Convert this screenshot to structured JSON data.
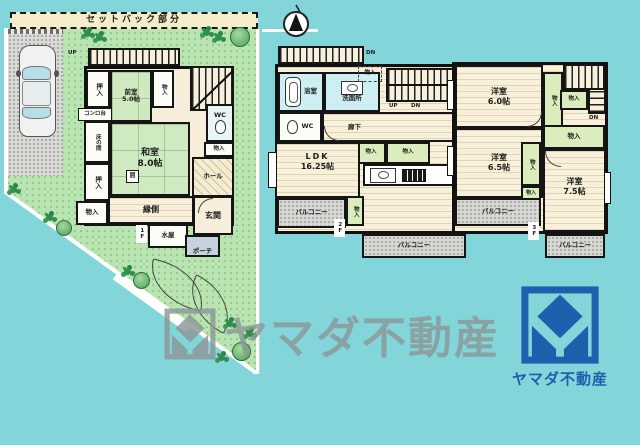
{
  "colors": {
    "background": "#82d5d8",
    "wall": "#151515",
    "lawn": "#b9e4b1",
    "tatami_green": "#cfe9c0",
    "wood_cream": "#f8f0da",
    "wet_room_cyan": "#cdeef2",
    "closet_green": "#dcedbd",
    "balcony_gray": "#d7d8d3",
    "setback_beige": "#f5edc9",
    "brand_blue": "#1d60ae",
    "watermark_gray": "#8c9898"
  },
  "icons": {
    "compass_north": "north-arrow",
    "bathtub": "tub-outline",
    "toilet": "toilet-oval",
    "kitchen_sink": "sink-rect",
    "kitchen_stove": "stove-grill",
    "yamada_mark": "square-diamond-house"
  },
  "site": {
    "setback_label": "セットバック部分"
  },
  "floor1": {
    "tag": "1F",
    "deck_up": "UP",
    "oshiire_a": "押入",
    "zenshitsu_name": "前室",
    "zenshitsu_size": "5.0帖",
    "monoiri_top": "物入",
    "konrodai": "コンロ台",
    "tokonoma": "床の間",
    "hearth": "囲",
    "oshiire_b": "押入",
    "monoiri_bl": "物入",
    "washitsu_name": "和室",
    "washitsu_size": "8.0帖",
    "wc": "WC",
    "monoiri_mid": "物入",
    "hall": "ホール",
    "engawa": "縁側",
    "mizuya": "水屋",
    "genkan": "玄関",
    "porch": "ポーチ"
  },
  "floor2": {
    "tag": "2F",
    "roof_dn": "DN",
    "bath": "浴室",
    "senmenjo": "洗面所",
    "monoiri_top": "物入",
    "wc": "WC",
    "rouka": "廊下",
    "stairs_up": "UP",
    "stairs_dn": "DN",
    "monoiri_a": "物入",
    "monoiri_b": "物入",
    "ldk_name": "LDK",
    "ldk_size": "16.25帖",
    "monoiri_c": "物入",
    "balcony_left": "バルコニー",
    "balcony_bottom": "バルコニー"
  },
  "floor3": {
    "tag": "3F",
    "stairs_dn": "DN",
    "yoshitsu6_name": "洋室",
    "yoshitsu6_size": "6.0帖",
    "monoiri_a": "物入",
    "monoiri_b": "物入",
    "yoshitsu65_name": "洋室",
    "yoshitsu65_size": "6.5帖",
    "monoiri_c": "物入",
    "monoiri_d": "物入",
    "monoiri_e": "物入",
    "yoshitsu75_name": "洋室",
    "yoshitsu75_size": "7.5帖",
    "balcony_left": "バルコニー",
    "balcony_bottom": "バルコニー"
  },
  "watermark": {
    "text": "ヤマダ不動産"
  },
  "brand": {
    "name": "ヤマダ不動産"
  }
}
